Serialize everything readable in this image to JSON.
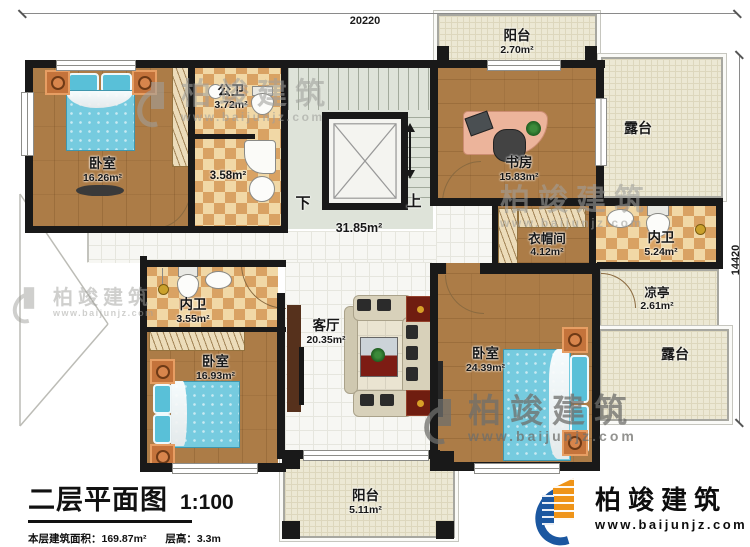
{
  "dimensions": {
    "top_width": "20220",
    "right_height": "14420"
  },
  "rooms": {
    "bedroom_tl": {
      "name": "卧室",
      "area": "16.26m²"
    },
    "public_bath": {
      "name": "公卫",
      "area": "3.72m²"
    },
    "bath_small": {
      "area": "3.58m²"
    },
    "study": {
      "name": "书房",
      "area": "15.83m²"
    },
    "balcony_top": {
      "name": "阳台",
      "area": "2.70m²"
    },
    "terrace_top": {
      "name": "露台"
    },
    "hall": {
      "area": "31.85m²"
    },
    "cloakroom": {
      "name": "衣帽间",
      "area": "4.12m²"
    },
    "ensuite_right": {
      "name": "内卫",
      "area": "5.24m²"
    },
    "pavilion": {
      "name": "凉亭",
      "area": "2.61m²"
    },
    "terrace_right": {
      "name": "露台"
    },
    "ensuite_left": {
      "name": "内卫",
      "area": "3.55m²"
    },
    "bedroom_bl": {
      "name": "卧室",
      "area": "16.93m²"
    },
    "living": {
      "name": "客厅",
      "area": "20.35m²"
    },
    "bedroom_br": {
      "name": "卧室",
      "area": "24.39m²"
    },
    "balcony_bottom": {
      "name": "阳台",
      "area": "5.11m²"
    }
  },
  "stairs": {
    "down": "下",
    "up": "上"
  },
  "title_block": {
    "title": "二层平面图",
    "scale": "1:100",
    "area_label": "本层建筑面积：",
    "area_value": "169.87m²",
    "height_label": "层高：",
    "height_value": "3.3m"
  },
  "brand": {
    "name": "柏竣建筑",
    "url": "www.baijunjz.com"
  },
  "watermark": {
    "name": "柏竣建筑",
    "url": "www.baijunjz.com"
  },
  "colors": {
    "wall": "#191919",
    "wood": "#ac7c47",
    "tile_light": "#f1d8a6",
    "tile_dark": "#d9a263",
    "brand_blue": "#1b57a0",
    "brand_orange": "#ef9418"
  }
}
